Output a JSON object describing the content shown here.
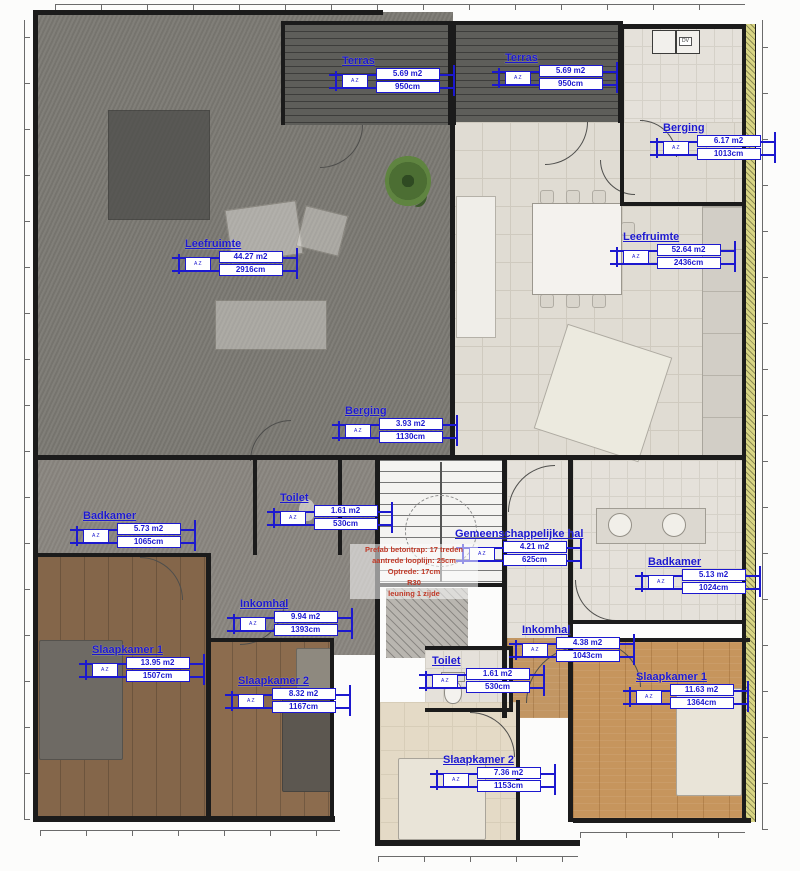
{
  "rooms": [
    {
      "name": "Terras",
      "area": "5.69 m2",
      "dim": "950cm"
    },
    {
      "name": "Terras",
      "area": "5.69 m2",
      "dim": "950cm"
    },
    {
      "name": "Berging",
      "area": "6.17 m2",
      "dim": "1013cm"
    },
    {
      "name": "Leefruimte",
      "area": "44.27 m2",
      "dim": "2916cm"
    },
    {
      "name": "Leefruimte",
      "area": "52.64 m2",
      "dim": "2436cm"
    },
    {
      "name": "Berging",
      "area": "3.93 m2",
      "dim": "1130cm"
    },
    {
      "name": "Toilet",
      "area": "1.61 m2",
      "dim": "530cm"
    },
    {
      "name": "Badkamer",
      "area": "5.73 m2",
      "dim": "1065cm"
    },
    {
      "name": "Gemeenschappelijke hal",
      "area": "4.21 m2",
      "dim": "625cm"
    },
    {
      "name": "Badkamer",
      "area": "5.13 m2",
      "dim": "1024cm"
    },
    {
      "name": "Inkomhal",
      "area": "9.94 m2",
      "dim": "1393cm"
    },
    {
      "name": "Inkomhal",
      "area": "4.38 m2",
      "dim": "1043cm"
    },
    {
      "name": "Slaapkamer 1",
      "area": "13.95 m2",
      "dim": "1507cm"
    },
    {
      "name": "Toilet",
      "area": "1.61 m2",
      "dim": "530cm"
    },
    {
      "name": "Slaapkamer 2",
      "area": "8.32 m2",
      "dim": "1167cm"
    },
    {
      "name": "Slaapkamer 1",
      "area": "11.63 m2",
      "dim": "1364cm"
    },
    {
      "name": "Slaapkamer 2",
      "area": "7.36 m2",
      "dim": "1153cm"
    }
  ],
  "zone_stamp_code": "A Z",
  "stair_note": [
    "Prefab betontrap: 17 treden",
    "aantrede looplijn: 25cm",
    "Optrede: 17cm",
    "R30",
    "leuning 1 zijde"
  ],
  "labels": {
    "appliance": "DV"
  },
  "colors": {
    "stamp_blue": "#1c18cf",
    "annotation_red": "#c03a28",
    "wall": "#1b1b1b",
    "left_apartment_overlay": "#7c7a74",
    "terrace_deck": "#5e5e5a",
    "tile_light": "#e0dcd3",
    "wood_floor": "#c6955d",
    "wood_floor_shaded": "#84664a",
    "insulation_hatch": "#d8d584"
  }
}
